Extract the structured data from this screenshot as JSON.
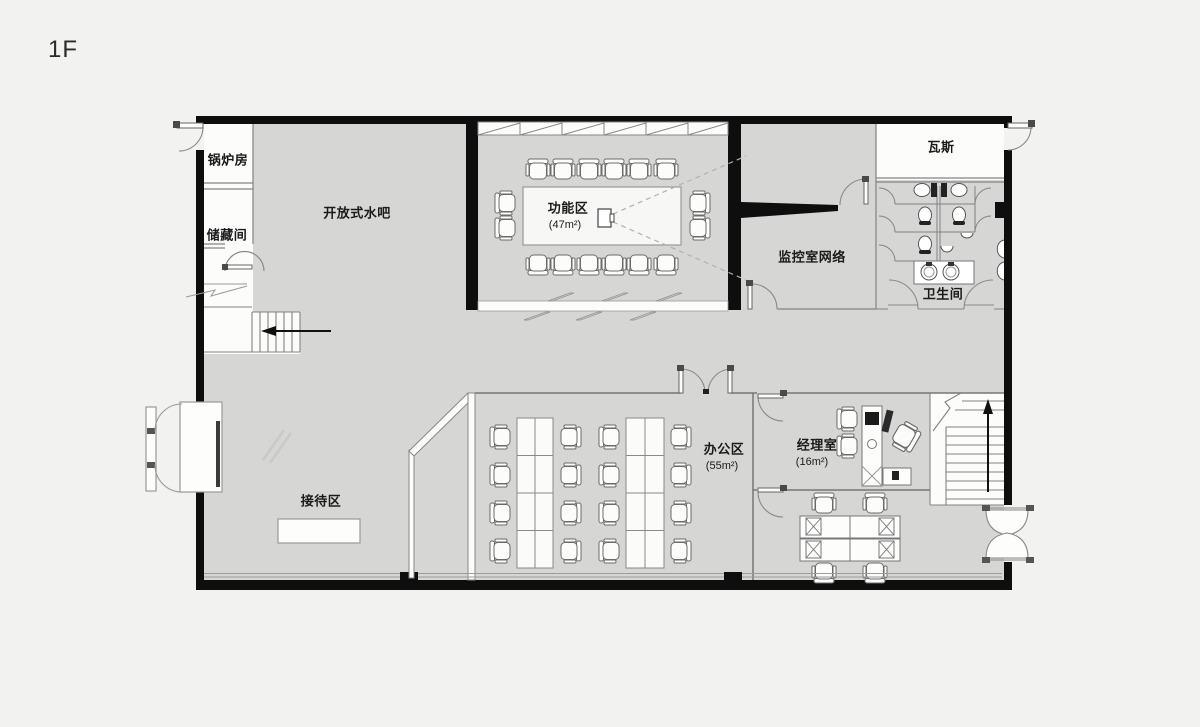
{
  "page": {
    "floor_label": "1F"
  },
  "rooms": {
    "boiler_room": {
      "label": "锅炉房"
    },
    "storage_room": {
      "label": "储藏间"
    },
    "open_water_bar": {
      "label": "开放式水吧"
    },
    "function_area": {
      "label": "功能区",
      "area": "(47m²)"
    },
    "gas_room": {
      "label": "瓦斯"
    },
    "monitor_network": {
      "label": "监控室网络"
    },
    "restroom": {
      "label": "卫生间"
    },
    "reception_area": {
      "label": "接待区"
    },
    "office_area": {
      "label": "办公区",
      "area": "(55m²)"
    },
    "manager_office": {
      "label": "经理室",
      "area": "(16m²)"
    }
  },
  "colors": {
    "background": "#f2f2f1",
    "floor_gray": "#d6d6d5",
    "room_white": "#fcfcfb",
    "wall_black": "#0e0e0e",
    "thin_line": "#8a8a8a",
    "text": "#1b1b1b"
  }
}
